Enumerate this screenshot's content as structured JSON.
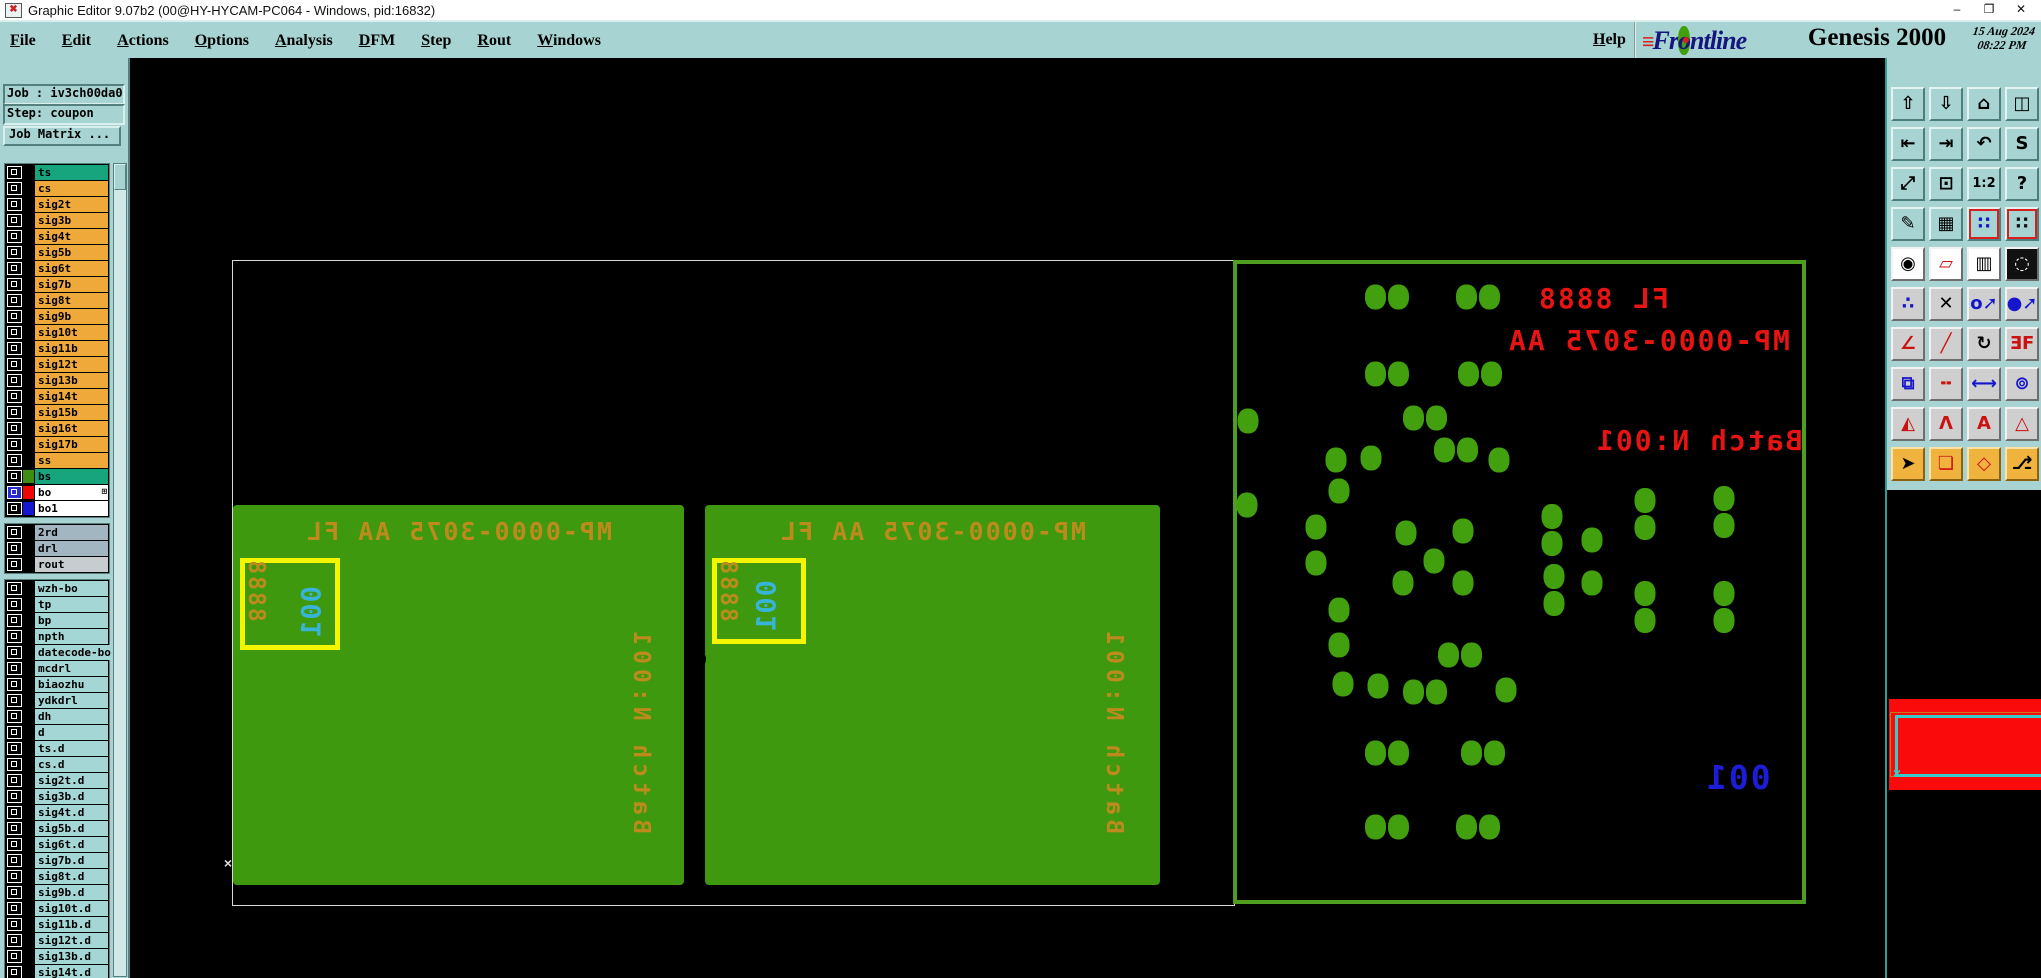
{
  "window": {
    "title": "Graphic Editor 9.07b2 (00@HY-HYCAM-PC064 - Windows, pid:16832)",
    "app_icon_glyph": "✖",
    "controls": {
      "minimize": "–",
      "maximize": "❐",
      "close": "✕"
    }
  },
  "menubar": {
    "items": [
      {
        "label": "File"
      },
      {
        "label": "Edit"
      },
      {
        "label": "Actions"
      },
      {
        "label": "Options"
      },
      {
        "label": "Analysis"
      },
      {
        "label": "DFM"
      },
      {
        "label": "Step"
      },
      {
        "label": "Rout"
      },
      {
        "label": "Windows"
      }
    ],
    "help_label": "Help"
  },
  "brand": {
    "stripes": "≡",
    "logo_pre": "Fr",
    "logo_dot": "o",
    "logo_post": "ntline",
    "product": "Genesis 2000",
    "date": "15 Aug 2024",
    "time": "08:22 PM",
    "subtitle": "Graphic Editor"
  },
  "job": {
    "job_label": "Job : iv3ch00da0",
    "step_label": "Step: coupon",
    "matrix_button": "Job Matrix ..."
  },
  "layers": {
    "sections": [
      {
        "default_bg": "#efa93a",
        "rows": [
          {
            "name": "ts",
            "bg": "#16a57d"
          },
          {
            "name": "cs"
          },
          {
            "name": "sig2t"
          },
          {
            "name": "sig3b"
          },
          {
            "name": "sig4t"
          },
          {
            "name": "sig5b"
          },
          {
            "name": "sig6t"
          },
          {
            "name": "sig7b"
          },
          {
            "name": "sig8t"
          },
          {
            "name": "sig9b"
          },
          {
            "name": "sig10t"
          },
          {
            "name": "sig11b"
          },
          {
            "name": "sig12t"
          },
          {
            "name": "sig13b"
          },
          {
            "name": "sig14t"
          },
          {
            "name": "sig15b"
          },
          {
            "name": "sig16t"
          },
          {
            "name": "sig17b"
          },
          {
            "name": "ss"
          },
          {
            "name": "bs",
            "bg": "#16a57d",
            "chip": "#3e8c10"
          },
          {
            "name": "bo",
            "bg": "#ffffff",
            "chip": "#f00505",
            "cb": "#2a2ad2",
            "badge": "⊞"
          },
          {
            "name": "bo1",
            "bg": "#ffffff",
            "chip": "#1616d2"
          }
        ]
      },
      {
        "default_bg": "#a2b6c2",
        "rows": [
          {
            "name": "2rd"
          },
          {
            "name": "drl"
          },
          {
            "name": "rout",
            "bg": "#c6ccd0"
          }
        ]
      },
      {
        "default_bg": "#a3d6d4",
        "rows": [
          {
            "name": "wzh-bo"
          },
          {
            "name": "tp"
          },
          {
            "name": "bp"
          },
          {
            "name": "npth"
          },
          {
            "name": "datecode-bo"
          },
          {
            "name": "mcdrl"
          },
          {
            "name": "biaozhu"
          },
          {
            "name": "ydkdrl"
          },
          {
            "name": "dh"
          },
          {
            "name": "d"
          },
          {
            "name": "ts.d"
          },
          {
            "name": "cs.d"
          },
          {
            "name": "sig2t.d"
          },
          {
            "name": "sig3b.d"
          },
          {
            "name": "sig4t.d"
          },
          {
            "name": "sig5b.d"
          },
          {
            "name": "sig6t.d"
          },
          {
            "name": "sig7b.d"
          },
          {
            "name": "sig8t.d"
          },
          {
            "name": "sig9b.d"
          },
          {
            "name": "sig10t.d"
          },
          {
            "name": "sig11b.d"
          },
          {
            "name": "sig12t.d"
          },
          {
            "name": "sig13b.d"
          },
          {
            "name": "sig14t.d"
          },
          {
            "name": "sig15b.d"
          }
        ]
      }
    ]
  },
  "toolbar": {
    "icons": [
      {
        "n": "paste-up-icon",
        "g": "⇧"
      },
      {
        "n": "paste-down-icon",
        "g": "⇩"
      },
      {
        "n": "home-view-icon",
        "g": "⌂"
      },
      {
        "n": "split-window-xy-icon",
        "g": "◫"
      },
      {
        "n": "shift-left-icon",
        "g": "⇤"
      },
      {
        "n": "shift-right-icon",
        "g": "⇥"
      },
      {
        "n": "undo-icon",
        "g": "↶"
      },
      {
        "n": "serpentine-icon",
        "g": "S"
      },
      {
        "n": "zoom-out-icon",
        "g": "⤢"
      },
      {
        "n": "zoom-center-icon",
        "g": "⊡"
      },
      {
        "n": "zoom-1-2-icon",
        "g": "1:2"
      },
      {
        "n": "help-icon",
        "g": "?"
      },
      {
        "n": "graphic-setup-icon",
        "g": "✎"
      },
      {
        "n": "grid-icon",
        "g": "▦"
      },
      {
        "n": "netlist-a-icon",
        "g": "∷",
        "fg": "#1515cc",
        "fr": true
      },
      {
        "n": "netlist-b-icon",
        "g": "∷",
        "fg": "#111111",
        "fr": true
      },
      {
        "n": "active-symbol-icon",
        "g": "◉",
        "bg": "white"
      },
      {
        "n": "transform-symbol-icon",
        "g": "▱",
        "bg": "white",
        "fg": "#cc1111"
      },
      {
        "n": "measure-ruler-icon",
        "g": "▥",
        "bg": "white"
      },
      {
        "n": "pad-dashed-icon",
        "g": "◌",
        "bg": "black"
      },
      {
        "n": "net-points-icon",
        "g": "∴",
        "bg": "gray",
        "fg": "#1515cc"
      },
      {
        "n": "delete-icon",
        "g": "✕",
        "bg": "gray"
      },
      {
        "n": "copy-circle-icon",
        "g": "o➚",
        "bg": "gray",
        "fg": "#1515cc"
      },
      {
        "n": "move-circle-icon",
        "g": "●➚",
        "bg": "gray",
        "fg": "#1515cc"
      },
      {
        "n": "angle-icon",
        "g": "∠",
        "bg": "gray",
        "fg": "#cc1111"
      },
      {
        "n": "slope-line-icon",
        "g": "╱",
        "bg": "gray",
        "fg": "#cc1111"
      },
      {
        "n": "rotate-icon",
        "g": "↻",
        "bg": "gray"
      },
      {
        "n": "mirror-icon",
        "g": "ƎF",
        "bg": "gray",
        "fg": "#cc1111"
      },
      {
        "n": "copy-pad-icon",
        "g": "⧉",
        "bg": "gray",
        "fg": "#1515cc"
      },
      {
        "n": "stretch-line-icon",
        "g": "╍",
        "bg": "gray",
        "fg": "#cc1111"
      },
      {
        "n": "measure-box-icon",
        "g": "⟷",
        "bg": "gray",
        "fg": "#1515cc"
      },
      {
        "n": "swap-symbols-icon",
        "g": "⊚",
        "bg": "gray",
        "fg": "#1515cc"
      },
      {
        "n": "peak-a-icon",
        "g": "◭",
        "bg": "gray",
        "fg": "#cc1111"
      },
      {
        "n": "peak-b-icon",
        "g": "Λ",
        "bg": "gray",
        "fg": "#cc1111"
      },
      {
        "n": "peak-c-icon",
        "g": "A",
        "bg": "gray",
        "fg": "#cc1111"
      },
      {
        "n": "peak-d-icon",
        "g": "△",
        "bg": "gray",
        "fg": "#cc1111"
      },
      {
        "n": "select-single-icon",
        "g": "➤",
        "bg": "orange"
      },
      {
        "n": "select-frame-icon",
        "g": "❏",
        "bg": "orange",
        "fg": "#cc1111"
      },
      {
        "n": "select-polygon-icon",
        "g": "◇",
        "bg": "orange",
        "fg": "#cc1111"
      },
      {
        "n": "select-net-icon",
        "g": "⎇",
        "bg": "orange"
      }
    ]
  },
  "canvas": {
    "boards": [
      {
        "top_text": "MP-0000-3075  AA  FL",
        "serial": "001",
        "code": "8888",
        "batch": "Batch N:001"
      },
      {
        "top_text": "MP-0000-3075  AA  FL",
        "serial": "001",
        "code": "8888",
        "batch": "Batch N:001"
      }
    ],
    "panel": {
      "line1": "FL 8888",
      "line2": "MP-0000-3075 AA",
      "line3": "Batch N:001",
      "serial": "001",
      "dots": [
        [
          1387,
          297,
          "h"
        ],
        [
          1478,
          297,
          "h"
        ],
        [
          1387,
          374,
          "h"
        ],
        [
          1480,
          374,
          "h"
        ],
        [
          1248,
          421,
          "s"
        ],
        [
          1425,
          418,
          "h"
        ],
        [
          1336,
          460,
          "s"
        ],
        [
          1371,
          458,
          "s"
        ],
        [
          1456,
          450,
          "h"
        ],
        [
          1499,
          460,
          "s"
        ],
        [
          1339,
          491,
          "s"
        ],
        [
          1247,
          505,
          "s"
        ],
        [
          1316,
          527,
          "s"
        ],
        [
          1406,
          533,
          "s"
        ],
        [
          1463,
          531,
          "s"
        ],
        [
          1552,
          530,
          "v"
        ],
        [
          1592,
          540,
          "s"
        ],
        [
          1645,
          514,
          "v"
        ],
        [
          1724,
          512,
          "v"
        ],
        [
          1316,
          563,
          "s"
        ],
        [
          1434,
          561,
          "s"
        ],
        [
          1403,
          583,
          "s"
        ],
        [
          1463,
          583,
          "s"
        ],
        [
          1554,
          590,
          "v"
        ],
        [
          1592,
          583,
          "s"
        ],
        [
          1645,
          607,
          "v"
        ],
        [
          1724,
          607,
          "v"
        ],
        [
          1339,
          610,
          "s"
        ],
        [
          1339,
          645,
          "s"
        ],
        [
          1460,
          655,
          "h"
        ],
        [
          1343,
          684,
          "s"
        ],
        [
          1378,
          686,
          "s"
        ],
        [
          1425,
          692,
          "h"
        ],
        [
          1506,
          690,
          "s"
        ],
        [
          1387,
          753,
          "h"
        ],
        [
          1483,
          753,
          "h"
        ],
        [
          1387,
          827,
          "h"
        ],
        [
          1478,
          827,
          "h"
        ]
      ]
    },
    "markers": {
      "origin_cross": "×",
      "select_cross": "×"
    }
  },
  "colors": {
    "ui_teal": "#a7d4d2",
    "board_green": "#3f990e",
    "dot_green": "#42a00e",
    "panel_border_green": "#4f9e1f",
    "board_text_orange": "#bd8a1e",
    "serial_cyan": "#38b4d8",
    "frame_yellow": "#f5f500",
    "panel_text_red": "#e81414",
    "panel_serial_blue": "#1d1dd8",
    "highlight_red": "#fa0a0a",
    "select_cyan": "#35cbcb",
    "row_orange": "#efa93a",
    "row_active_teal": "#16a57d"
  }
}
